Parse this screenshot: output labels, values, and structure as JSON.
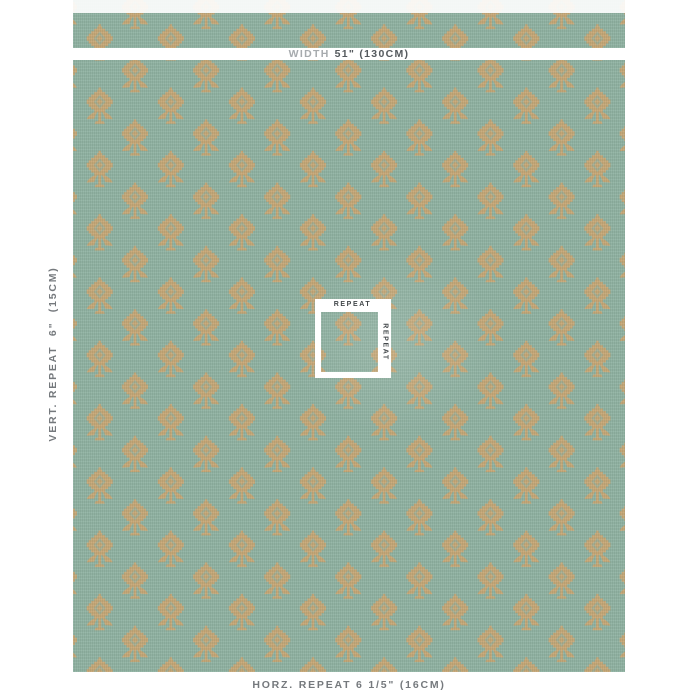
{
  "view": {
    "type": "fabric-swatch-dimension-view"
  },
  "colors": {
    "canvas": "#ffffff",
    "fabric_ground": "#8fb1a1",
    "motif_gold": "#c9a572",
    "measure_label_gray": "#75797d",
    "width_label_gray": "#a7abae",
    "width_value_gray": "#54595d",
    "repeat_label_gray": "#43484b",
    "marker_white": "#ffffff"
  },
  "fabric": {
    "pattern_name": "gold floral sprig motif on sage green ground",
    "texture": "woven linen",
    "layout": "half-drop diamond repeat"
  },
  "measurements": {
    "width_label": "WIDTH",
    "width_value": "51\" (130CM)",
    "vertical_repeat": "VERT. REPEAT  6\"  (15CM)",
    "horizontal_repeat": "HORZ. REPEAT 6 1/5\" (16CM)",
    "repeat_marker_top": "REPEAT",
    "repeat_marker_side": "REPEAT"
  }
}
